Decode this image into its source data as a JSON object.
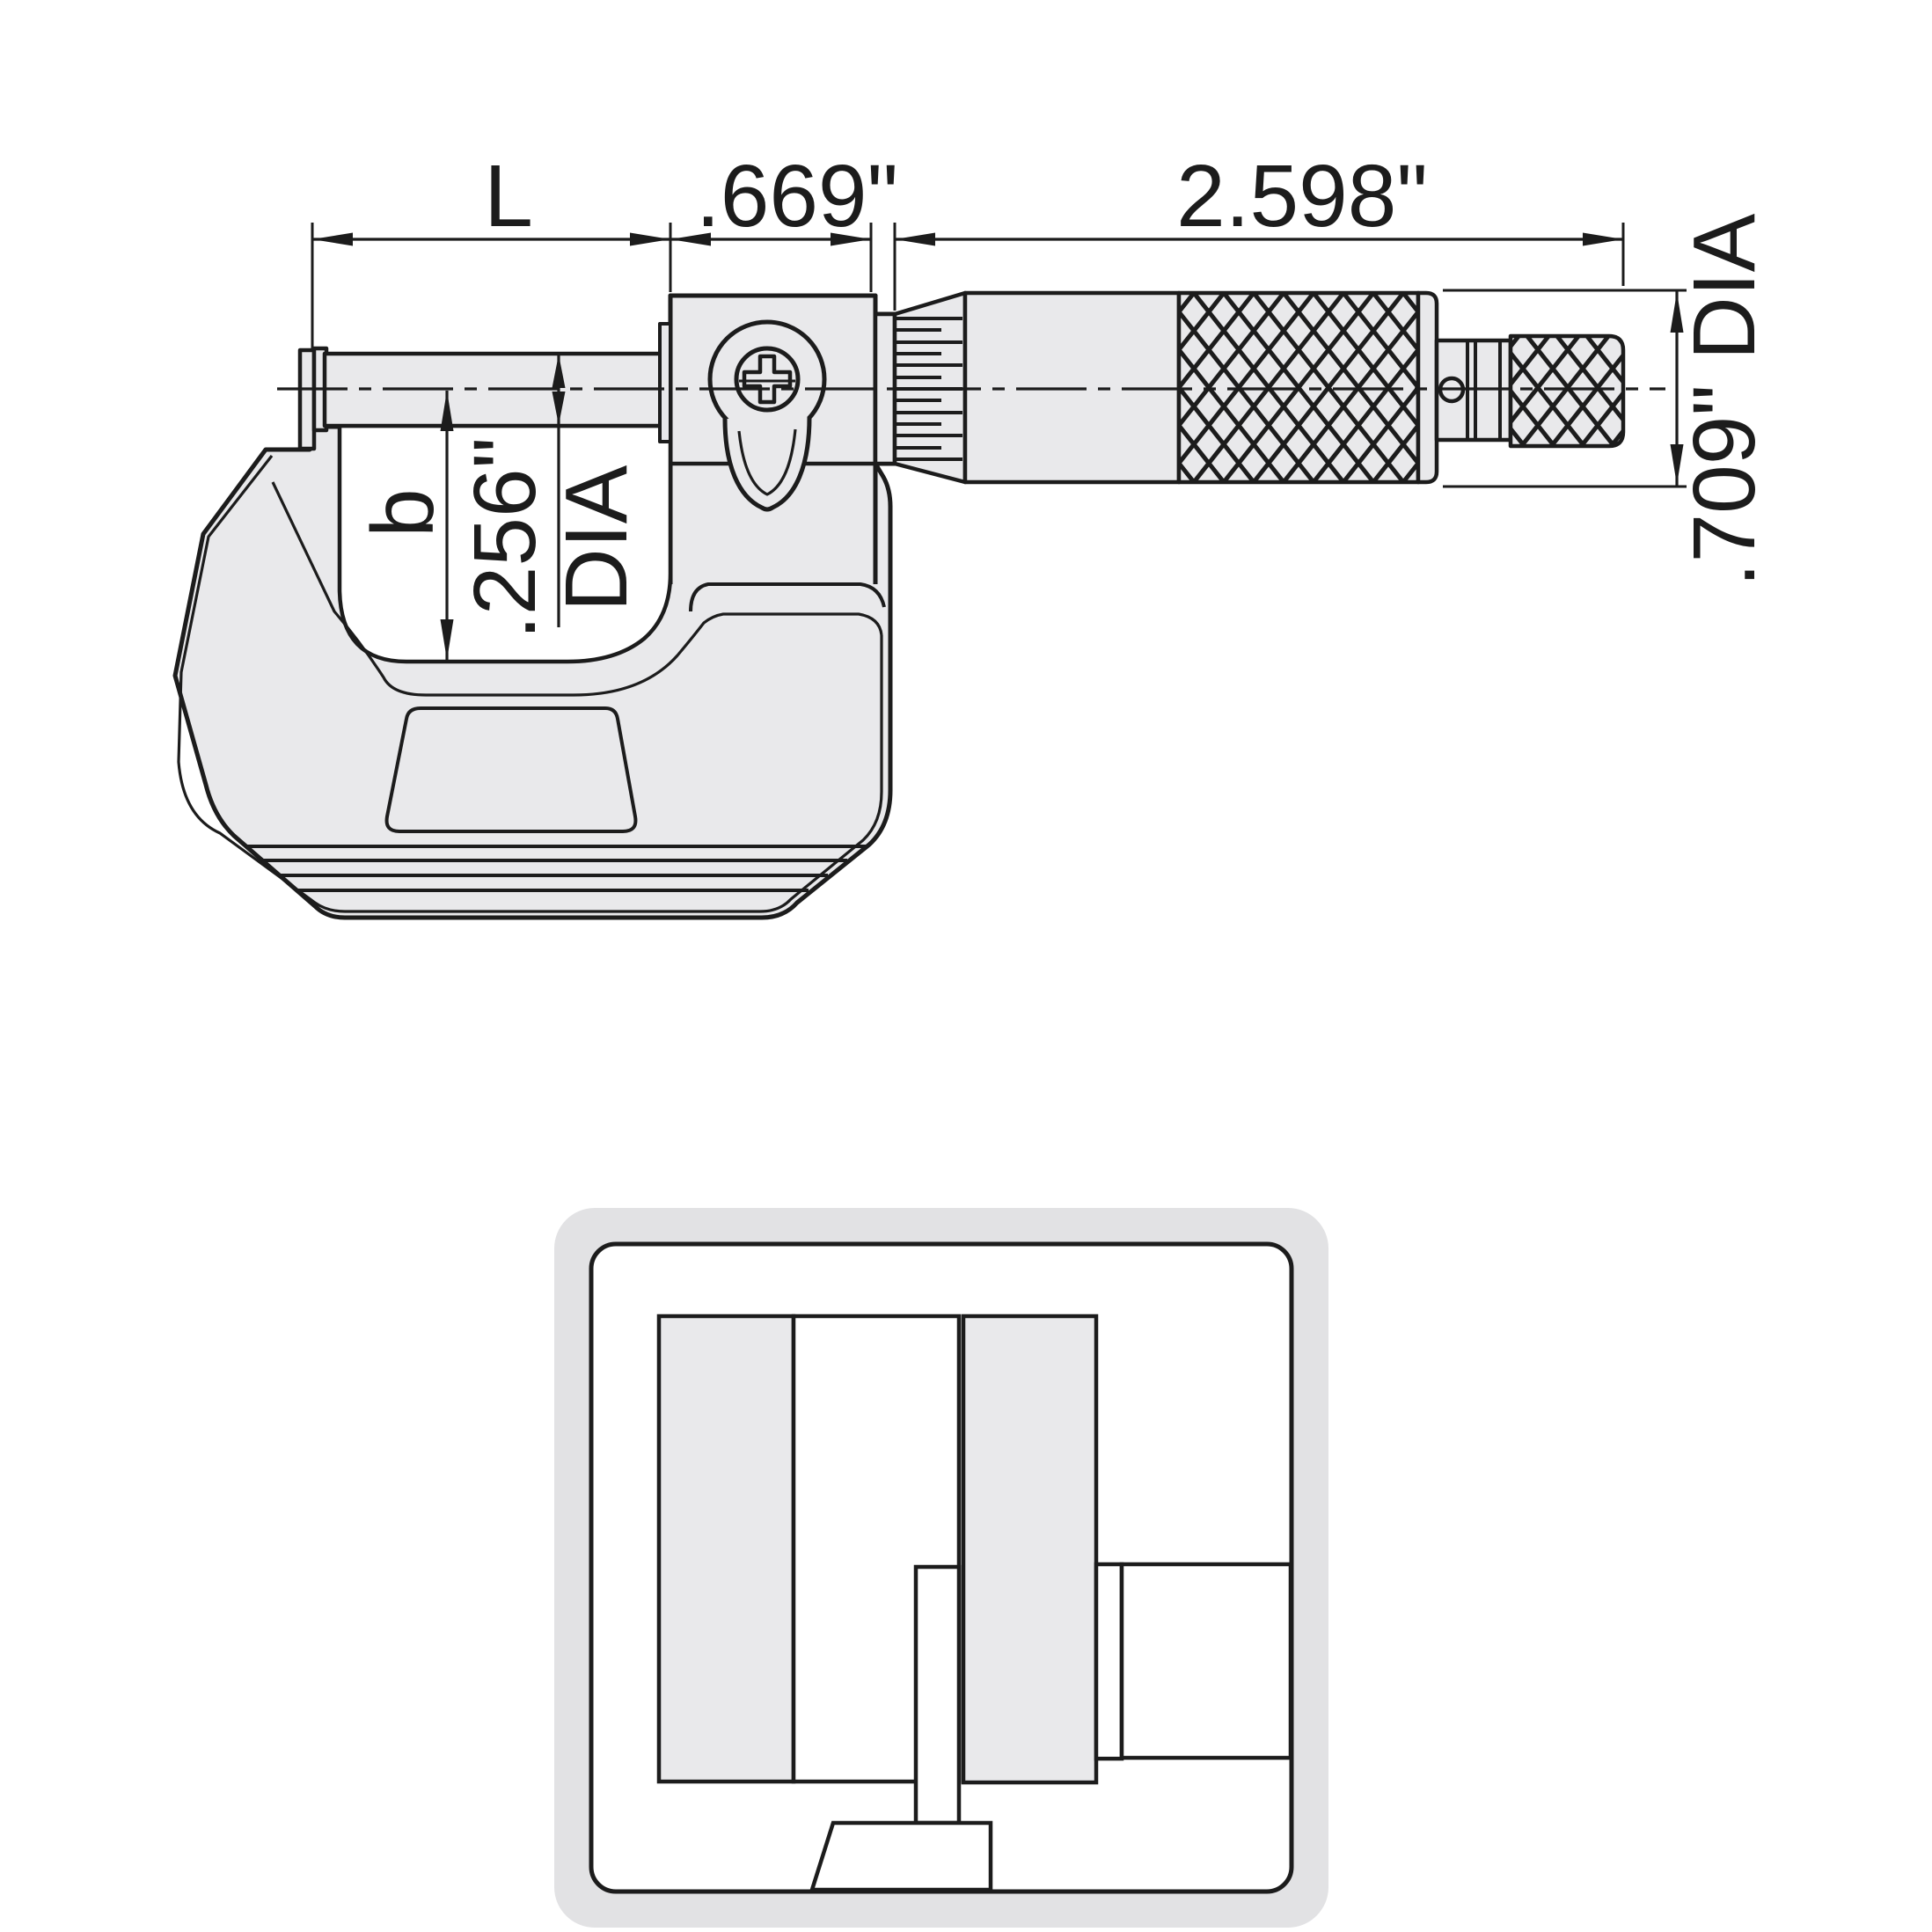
{
  "drawing": {
    "type": "micrometer-technical-diagram",
    "dims": {
      "rod_length": "L",
      "body_width": ".669\"",
      "thimble_length": "2.598\"",
      "thimble_diameter": ".709\" DIA",
      "throat_depth": "b",
      "spindle_diameter": ".256\"",
      "spindle_diameter_unit": "DIA"
    },
    "colors": {
      "line": "#1c1c1c",
      "metal_fill": "#e9e9eb",
      "inset_band": "#e2e2e4",
      "background": "#ffffff"
    }
  }
}
